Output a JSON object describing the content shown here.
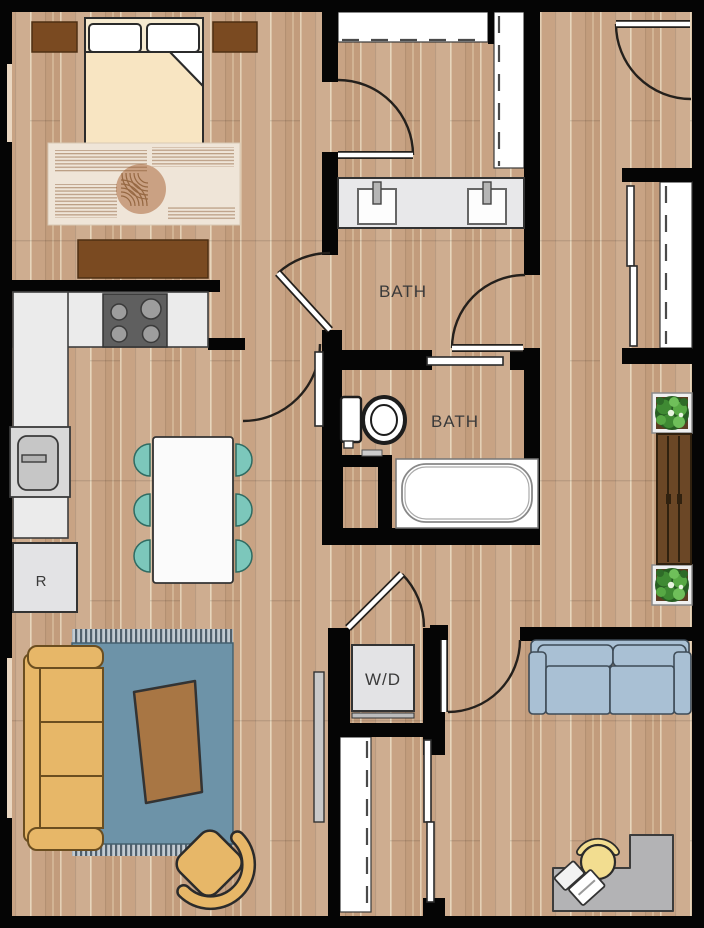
{
  "labels": {
    "bath_top": "BATH",
    "bath_middle": "BATH",
    "washer_dryer": "W/D",
    "refrigerator": "R"
  },
  "palette": {
    "wall": "#050505",
    "floor-base": "#c8a384",
    "counter": "#ebebeb",
    "appliance-gray": "#e3e3e5",
    "stove": "#5f5f5f",
    "burner": "#9d9d9d",
    "wood-dark": "#7a4a21",
    "bed-blanket": "#f8e5c2",
    "bedroom-rug": "#efe5d8",
    "rug-accent": "#caa183",
    "table-white": "#fbfbfb",
    "chair-teal": "#7cc7bb",
    "sofa-mustard": "#e7b768",
    "living-rug": "#6d93a8",
    "coffee-table": "#a87644",
    "loveseat-blue": "#a9c0d4",
    "desk-gray": "#b3b3b5",
    "desk-chair-yellow": "#f2dd90",
    "bench-brown": "#6b4726",
    "plant-green": "#4e9b3f",
    "window": "#ead7c1",
    "label-text": "#3a3a3a"
  }
}
